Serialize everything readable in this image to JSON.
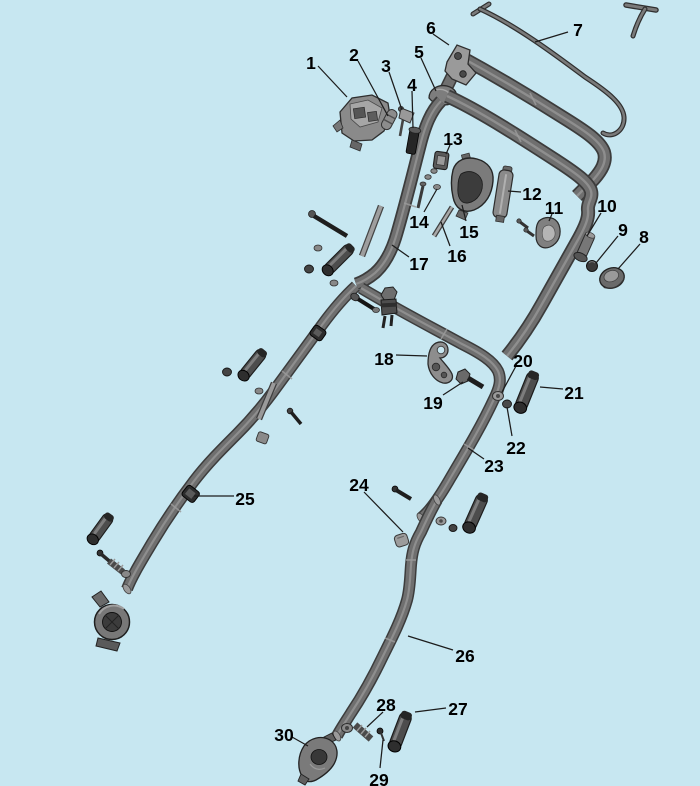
{
  "diagram": {
    "type": "exploded-parts-diagram",
    "background_color": "#c7e7f1",
    "part_fill_color": "#787878",
    "part_dark_color": "#2f2f2f",
    "outline_color": "#3c3c3c",
    "label_color": "#000000",
    "leader_color": "#1c1c1c",
    "labels": [
      {
        "num": "1",
        "x": 311,
        "y": 63,
        "leader": [
          318,
          66,
          347,
          97
        ]
      },
      {
        "num": "2",
        "x": 354,
        "y": 55,
        "leader": [
          358,
          61,
          388,
          116
        ]
      },
      {
        "num": "3",
        "x": 386,
        "y": 66,
        "leader": [
          389,
          72,
          402,
          110
        ]
      },
      {
        "num": "4",
        "x": 412,
        "y": 85,
        "leader": [
          412,
          91,
          413,
          128
        ]
      },
      {
        "num": "5",
        "x": 419,
        "y": 52,
        "leader": [
          421,
          58,
          436,
          91
        ]
      },
      {
        "num": "6",
        "x": 431,
        "y": 28,
        "leader": [
          433,
          34,
          449,
          45
        ]
      },
      {
        "num": "7",
        "x": 578,
        "y": 30,
        "leader": [
          568,
          32,
          535,
          42
        ]
      },
      {
        "num": "8",
        "x": 644,
        "y": 237,
        "leader": [
          640,
          244,
          618,
          269
        ]
      },
      {
        "num": "9",
        "x": 623,
        "y": 230,
        "leader": [
          618,
          236,
          596,
          263
        ]
      },
      {
        "num": "10",
        "x": 607,
        "y": 206,
        "leader": [
          601,
          213,
          587,
          236
        ]
      },
      {
        "num": "11",
        "x": 554,
        "y": 208,
        "leader": [
          552,
          214,
          549,
          221
        ]
      },
      {
        "num": "12",
        "x": 532,
        "y": 194,
        "leader": [
          521,
          192,
          508,
          191
        ]
      },
      {
        "num": "13",
        "x": 453,
        "y": 139,
        "leader": [
          450,
          145,
          446,
          154
        ]
      },
      {
        "num": "14",
        "x": 419,
        "y": 222,
        "leader": [
          424,
          212,
          437,
          189
        ]
      },
      {
        "num": "15",
        "x": 469,
        "y": 232,
        "leader": [
          466,
          221,
          462,
          205
        ]
      },
      {
        "num": "16",
        "x": 457,
        "y": 256,
        "leader": [
          450,
          246,
          441,
          222
        ]
      },
      {
        "num": "17",
        "x": 419,
        "y": 264,
        "leader": [
          409,
          257,
          392,
          245
        ]
      },
      {
        "num": "18",
        "x": 384,
        "y": 359,
        "leader": [
          396,
          355,
          427,
          356
        ]
      },
      {
        "num": "19",
        "x": 433,
        "y": 403,
        "leader": [
          443,
          395,
          463,
          382
        ]
      },
      {
        "num": "20",
        "x": 523,
        "y": 361,
        "leader": [
          516,
          366,
          502,
          392
        ]
      },
      {
        "num": "21",
        "x": 574,
        "y": 393,
        "leader": [
          563,
          389,
          540,
          387
        ]
      },
      {
        "num": "22",
        "x": 516,
        "y": 448,
        "leader": [
          512,
          436,
          507,
          407
        ]
      },
      {
        "num": "23",
        "x": 494,
        "y": 466,
        "leader": [
          484,
          459,
          468,
          448
        ]
      },
      {
        "num": "24",
        "x": 359,
        "y": 485,
        "leader": [
          364,
          492,
          403,
          532
        ]
      },
      {
        "num": "25",
        "x": 245,
        "y": 499,
        "leader": [
          234,
          496,
          194,
          496
        ]
      },
      {
        "num": "26",
        "x": 465,
        "y": 656,
        "leader": [
          453,
          650,
          408,
          636
        ]
      },
      {
        "num": "27",
        "x": 458,
        "y": 709,
        "leader": [
          446,
          708,
          415,
          712
        ]
      },
      {
        "num": "28",
        "x": 386,
        "y": 705,
        "leader": [
          383,
          712,
          367,
          727
        ]
      },
      {
        "num": "29",
        "x": 379,
        "y": 780,
        "leader": [
          380,
          768,
          383,
          740
        ]
      },
      {
        "num": "30",
        "x": 284,
        "y": 735,
        "leader": [
          292,
          737,
          308,
          746
        ]
      }
    ]
  }
}
